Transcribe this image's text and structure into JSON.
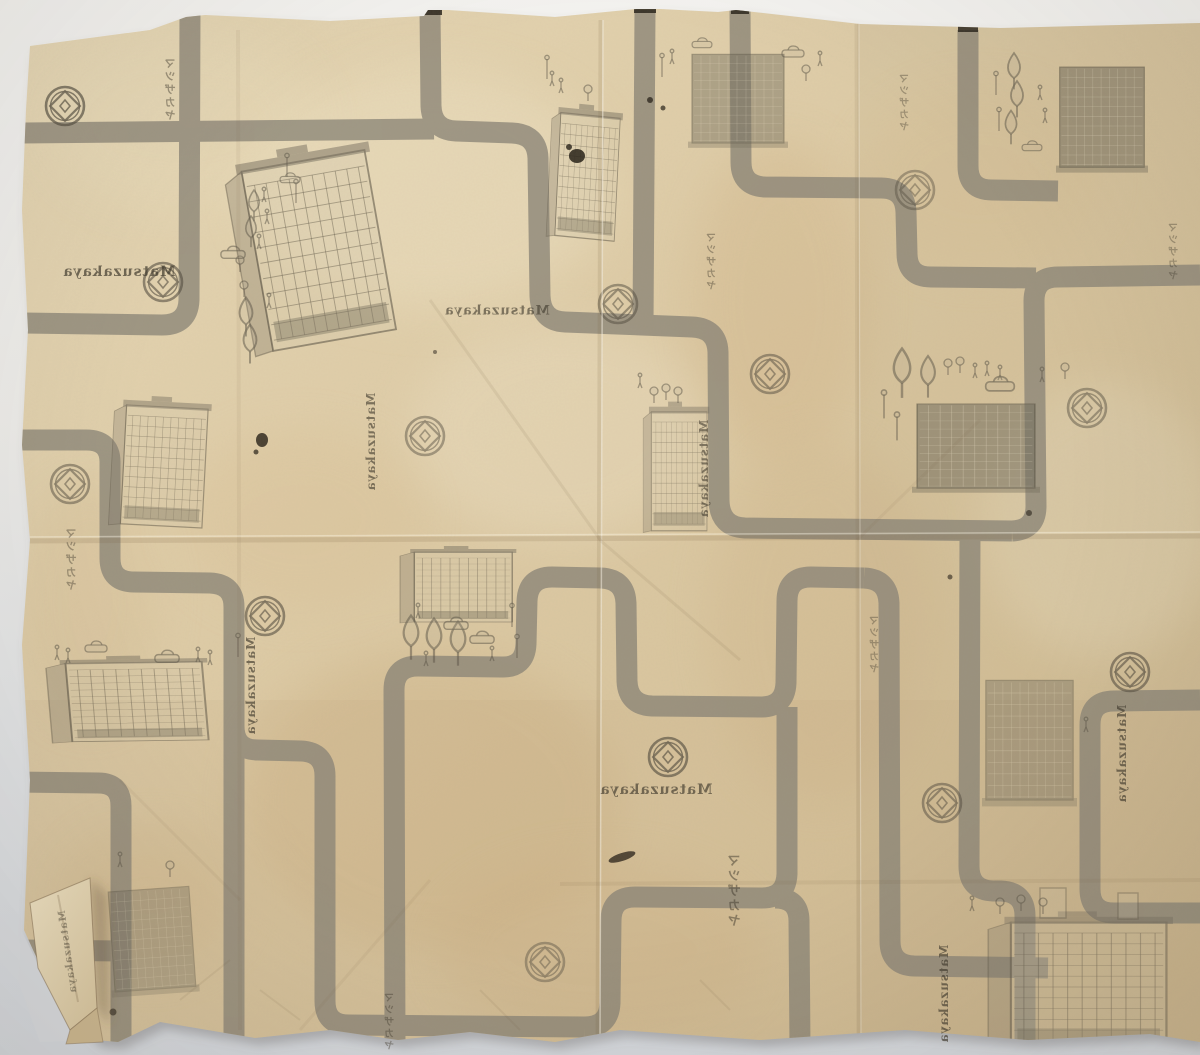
{
  "image": {
    "type": "photograph",
    "subject": "Vintage Matsuzakaya department-store wrapping paper photographed on a grey surface; the printed street-map pattern (roads, store buildings, trees, cars, trademark) shows through in mirror image, with fold creases and a torn, folded lower-left corner"
  },
  "palette": {
    "backdrop_top": "#f3f2ef",
    "backdrop_bottom": "#d3d6da",
    "paper_light": "#e7d8b6",
    "paper_base": "#dcc9a3",
    "paper_shade": "#c6b28a",
    "road_grey": "#8b8577",
    "print_ink": "#5e594a",
    "blot_ink": "#241e15"
  },
  "labels": {
    "latin": "Matsuzakaya",
    "katakana": "マツザカヤ"
  },
  "icons": {
    "logo": "matsuzakaya-circle-diamond-trademark"
  },
  "motifs": {
    "roads": "grey street grid with rounded corners",
    "buildings": "department-store blocks with window grids",
    "street_items": "trees, cars, pedestrians, street lamps"
  }
}
